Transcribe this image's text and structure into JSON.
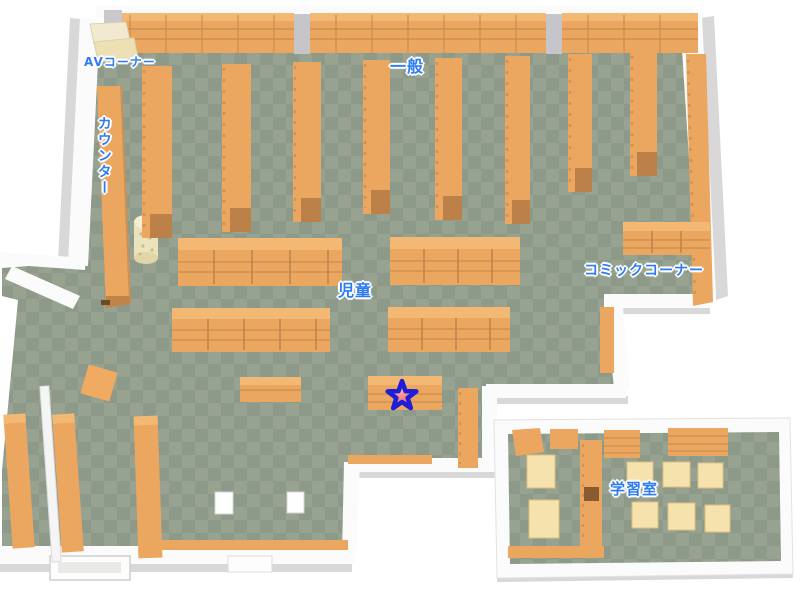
{
  "labels": {
    "av_corner": "AVコーナー",
    "counter": "カウンター",
    "general": "一般",
    "children": "児童",
    "comic_corner": "コミックコーナー",
    "study_room": "学習室"
  },
  "marker": {
    "symbol": "star",
    "location_area": "児童"
  },
  "colors": {
    "background": "#ffffff",
    "floor_light": "#97a290",
    "floor_dark": "#8d9a89",
    "shelf_orange": "#eba660",
    "shelf_top": "#f3b873",
    "shelf_line": "#cf9152",
    "shelf_cap": "#bb8149",
    "table_cream": "#f6e2ac",
    "cabinet_cream": "#eee3bb",
    "wall_white": "#fbfbfb",
    "wall_shade": "#d8d8d8",
    "pillar_gray": "#c6c6ca",
    "label_blue": "#2e7cf0",
    "star_fill": "#ee5f63",
    "star_outline": "#1e1ed8"
  }
}
